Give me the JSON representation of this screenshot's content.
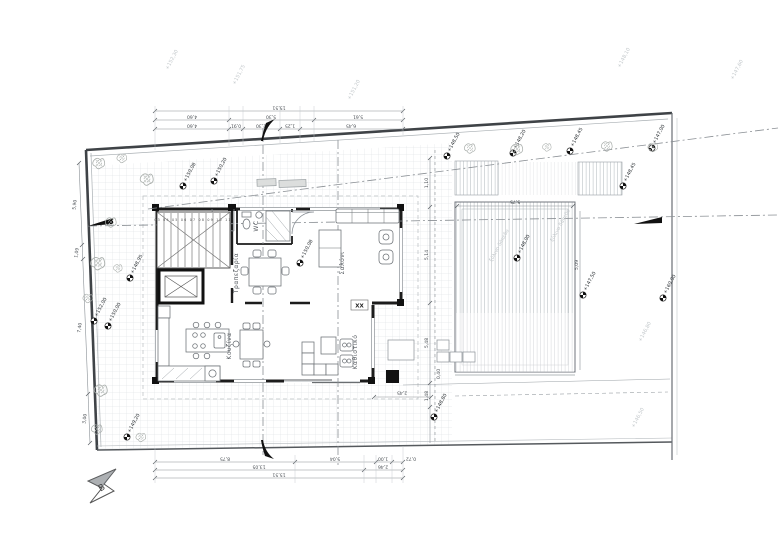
{
  "page": {
    "kind": "scanned architectural ground-floor plan",
    "language": "Greek"
  },
  "rooms": {
    "living": "Σαλόνι",
    "dining": "Τραπεζαρία",
    "kitchen": "Κουζίνα",
    "sitting": "Καθιστικό",
    "wc": "WC"
  },
  "stair": {
    "numbers": "03 04 05 06 07 08 09 10 11"
  },
  "section": {
    "label": "XX"
  },
  "north": {
    "label": "B"
  },
  "deck": {
    "note": "ξύλινο δάπεδο",
    "note2": "ξύλινο δάπεδο"
  },
  "levels": [
    "+150,08",
    "+150,20",
    "+148,50",
    "+148,20",
    "+148,45",
    "+147,00",
    "+148,45",
    "+152,00",
    "+150,00",
    "+148,95",
    "+150,08",
    "+148,00",
    "+160,00",
    "+148,80",
    "+149,20",
    "+147,50"
  ],
  "neighbor_levels": [
    "+152,30",
    "+151,75",
    "+151,20",
    "+148,10",
    "+147,60",
    "+146,80",
    "+146,50"
  ],
  "dims": {
    "top_row1": [
      "15,51"
    ],
    "top_row2": [
      "4,60",
      "5,30",
      "5,61"
    ],
    "top_row3": [
      "4,60",
      "0,91",
      "2,30",
      "1,25",
      "6,45"
    ],
    "bottom_row1": [
      "8,75",
      "5,04",
      "1,00",
      "0,72"
    ],
    "bottom_row2": [
      "13,05",
      "2,46"
    ],
    "bottom_row3": [
      "15,51"
    ],
    "left": [
      "5,90",
      "1,09",
      "7,40",
      "3,00"
    ],
    "right": [
      "1,10",
      "5,14",
      "5,48",
      "1,48"
    ],
    "deck_top": "5,75",
    "deck_right": "5,09",
    "terrace": "2,45",
    "col_offset": "0,40"
  },
  "colors": {
    "wall": "#1c1c1c",
    "dim_line": "#8a9096",
    "grid": "#d8dcdf",
    "deck_hatch": "#b6bcc1",
    "boundary": "#3f4347"
  }
}
